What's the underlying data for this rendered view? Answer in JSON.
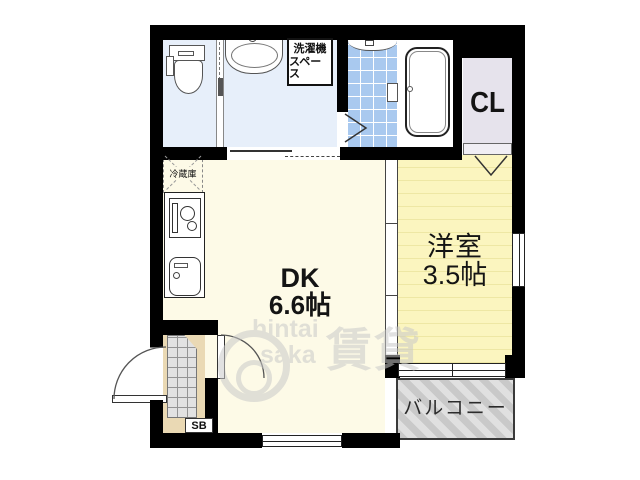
{
  "rooms": {
    "dining_kitchen": {
      "name": "DK",
      "size": "6.6帖"
    },
    "western_room": {
      "name": "洋室",
      "size": "3.5帖"
    },
    "closet": {
      "name": "CL"
    },
    "balcony": {
      "name": "バルコニー"
    },
    "laundry_space": {
      "line1": "洗濯機",
      "line2": "スペース"
    },
    "refrigerator": {
      "name": "冷蔵庫"
    },
    "shoe_box": {
      "name": "SB"
    }
  },
  "watermark": {
    "text_top": "hintai",
    "text_bottom": "saka",
    "kanji": "賃貸"
  },
  "colors": {
    "wall": "#000000",
    "water_floor": "#e7effa",
    "tile_floor": "#a9c9ef",
    "dk_floor": "#fdfae7",
    "western_floor": "#fbf5bf",
    "western_stripe": "#eee7a4",
    "closet_floor": "#e6e3ec",
    "entrance_floor": "#ead9b4",
    "tataki": "#e2e2e2",
    "balcony_a": "#c9c9c9",
    "balcony_b": "#e0e0e0"
  }
}
